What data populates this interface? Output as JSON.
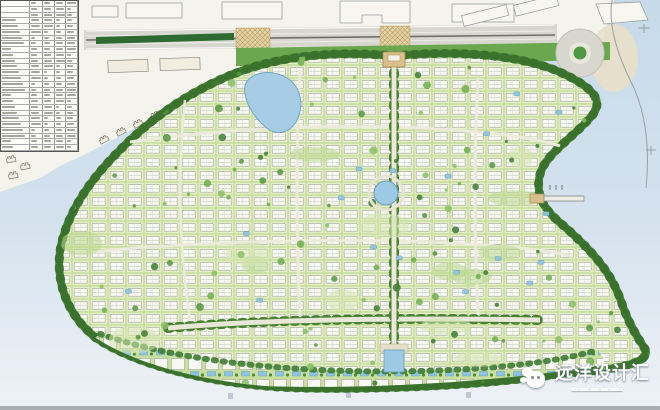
{
  "plan": {
    "type": "residential-master-plan",
    "watermark": {
      "label": "远洋设计汇",
      "logo_icon": "cloud-mascot-icon"
    },
    "indicator_table": {
      "legible": false
    },
    "water_label_marks": 3
  },
  "colors": {
    "water_upper": "#c6daea",
    "water_lower": "#e9eef5",
    "land": "#f4f3ec",
    "parcel": "#f1efe6",
    "site_green": "#c9dfa0",
    "courtyard": "#e6eec8",
    "belt_green": "#4c8a39",
    "tree_green": "#3e7c33",
    "road_gray": "#d8d7cf",
    "hatch_tan": "#e0cf9e",
    "pool_blue": "#8fc4e0",
    "building_white": "#f8f9f2",
    "median_green": "#2e6b33",
    "gate_tan": "#d9c08a",
    "frame_gray": "#a9aeb2"
  }
}
